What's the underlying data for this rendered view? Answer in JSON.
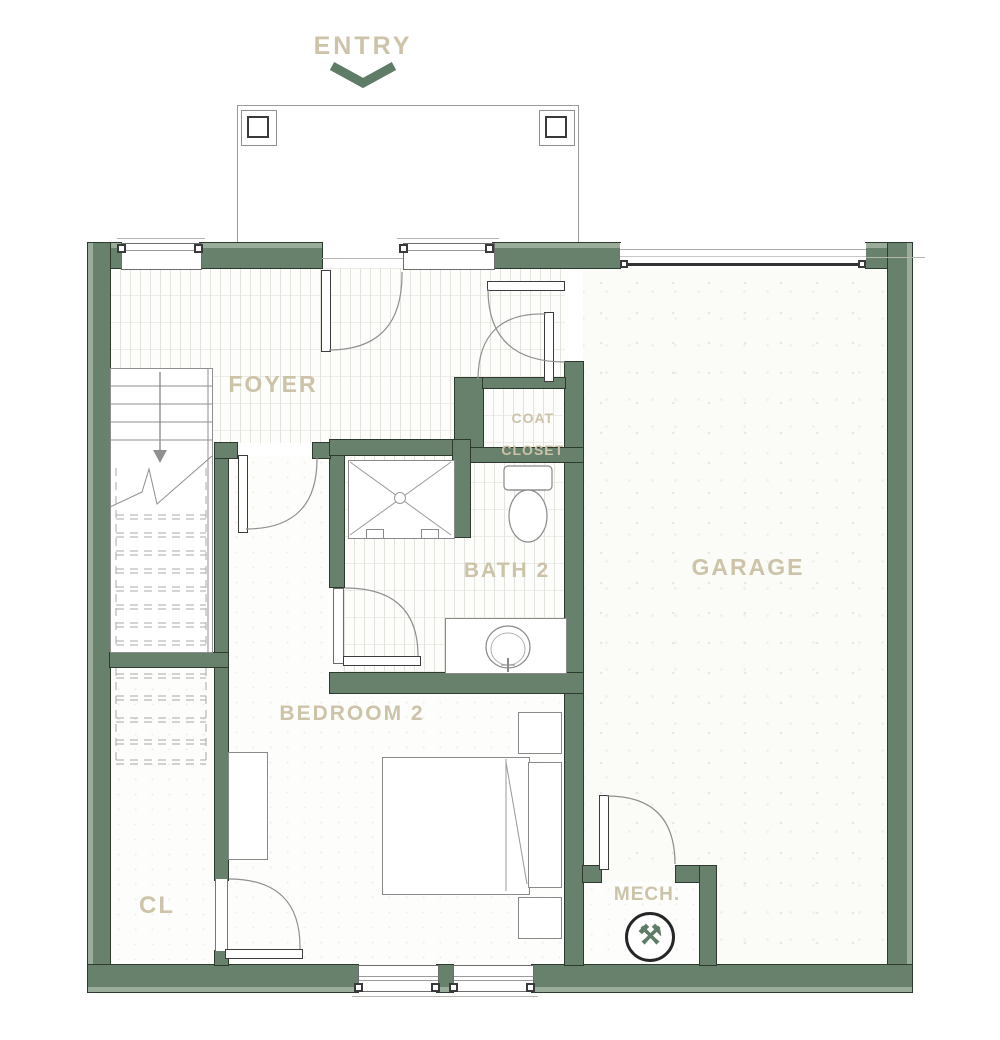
{
  "plan": {
    "entry": {
      "label": "ENTRY"
    },
    "rooms": {
      "foyer": {
        "label": "FOYER"
      },
      "garage": {
        "label": "GARAGE"
      },
      "bath": {
        "label": "BATH 2"
      },
      "bedroom": {
        "label": "BEDROOM 2"
      },
      "closet": {
        "label": "CL"
      },
      "mech": {
        "label": "MECH."
      },
      "coat_closet": {
        "label_line1": "COAT",
        "label_line2": "CLOSET"
      }
    },
    "icons": {
      "mech_tools": "⚒",
      "entry_arrow": "chevron-down"
    },
    "colors": {
      "wall_green": "#68816c",
      "wall_light": "#9aac9a",
      "label_tan": "#cdc3a8",
      "arrow_green": "#5e7c66"
    }
  }
}
